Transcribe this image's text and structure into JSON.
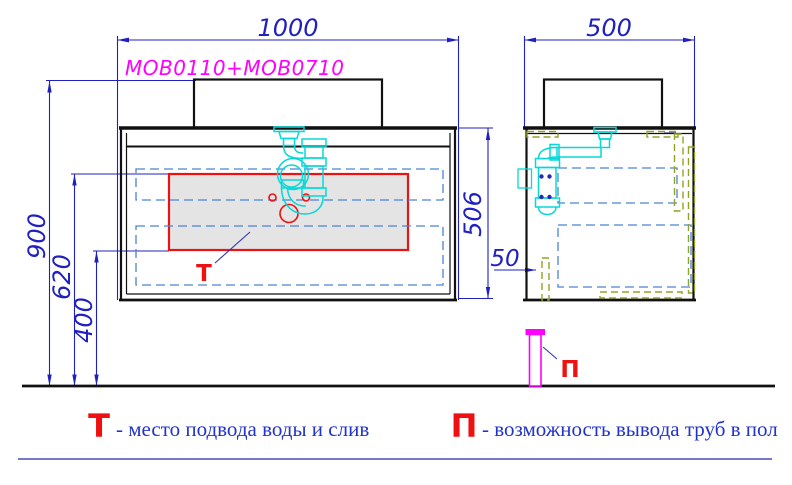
{
  "title_code": "MOB0110+MOB0710",
  "dimensions": {
    "front_width": "1000",
    "side_depth": "500",
    "total_height": "900",
    "zone_top_height": "620",
    "zone_bottom_height": "400",
    "cabinet_height": "506",
    "pipe_wall_offset": "50"
  },
  "markers": {
    "water_marker": "Т",
    "floor_pipe_marker": "П"
  },
  "legend": [
    {
      "marker": "Т",
      "text": "- место подвода воды и слив"
    },
    {
      "marker": "П",
      "text": "- возможность вывода труб в пол"
    }
  ],
  "colors": {
    "dimension_blue": "#2020c0",
    "dashed_blue": "#4a83d4",
    "accent_red": "#ee1111",
    "magenta": "#ff00ff",
    "cyan": "#06d8d8",
    "olive": "#93a325",
    "legend_blue": "#2233cc"
  }
}
